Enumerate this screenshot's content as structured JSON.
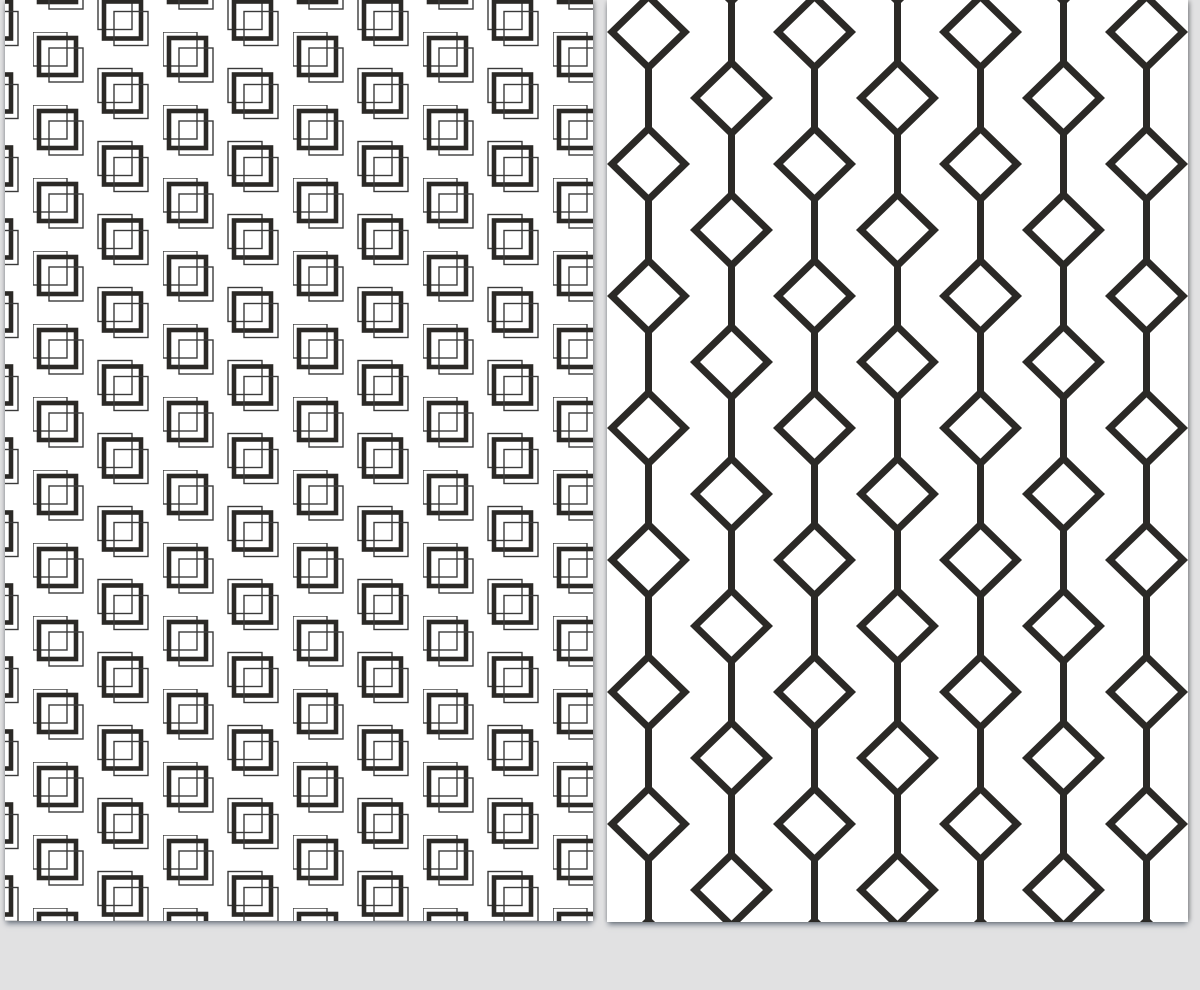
{
  "scene": {
    "description": "Two black-and-white seamless geometric pattern swatches displayed side by side on a light gray backdrop",
    "background_color": "#e1e1e2",
    "shadow_color": "rgba(72,84,100,0.65)"
  },
  "sheets": {
    "left": {
      "name": "overlapping-squares-pattern-sheet",
      "paper_color": "#ffffff",
      "x": 5,
      "y": 0,
      "width": 588,
      "height": 921,
      "pattern": {
        "type": "overlapping-offset-squares",
        "ink_color": "#2b2926",
        "thin_color": "#3a3a3a",
        "tile_width": 130,
        "tile_height": 73,
        "column_spacing": 65,
        "row_spacing": 73,
        "half_drop": 36.5,
        "phase_x": 28,
        "phase_y": 32,
        "motif_positions": [
          [
            0,
            0
          ],
          [
            65,
            36.5
          ],
          [
            65,
            -36.5
          ]
        ],
        "squares": [
          {
            "dx": 0,
            "dy": 0,
            "size": 34,
            "stroke_width": 1.4,
            "role": "back-thin-square"
          },
          {
            "dx": 6,
            "dy": 6,
            "size": 37,
            "stroke_width": 4.6,
            "role": "middle-thick-square"
          },
          {
            "dx": 16,
            "dy": 16,
            "size": 34,
            "stroke_width": 1.4,
            "role": "front-thin-square"
          }
        ]
      }
    },
    "right": {
      "name": "diamond-chain-pattern-sheet",
      "paper_color": "#ffffff",
      "x": 607,
      "y": 0,
      "width": 581,
      "height": 922,
      "pattern": {
        "type": "diamond-chains",
        "ink_color": "#2b2926",
        "tile_width": 166,
        "tile_height": 132,
        "chain_spacing": 83,
        "first_chain_x": 41.5,
        "second_chain_x": 124.5,
        "vertical_period": 132,
        "even_chain_diamond_centers_y": [
          32,
          164
        ],
        "odd_chain_diamond_centers_y": [
          -34,
          98
        ],
        "diamond_half_width": 36.5,
        "diamond_half_height": 35.5,
        "stroke_width": 7
      }
    }
  }
}
